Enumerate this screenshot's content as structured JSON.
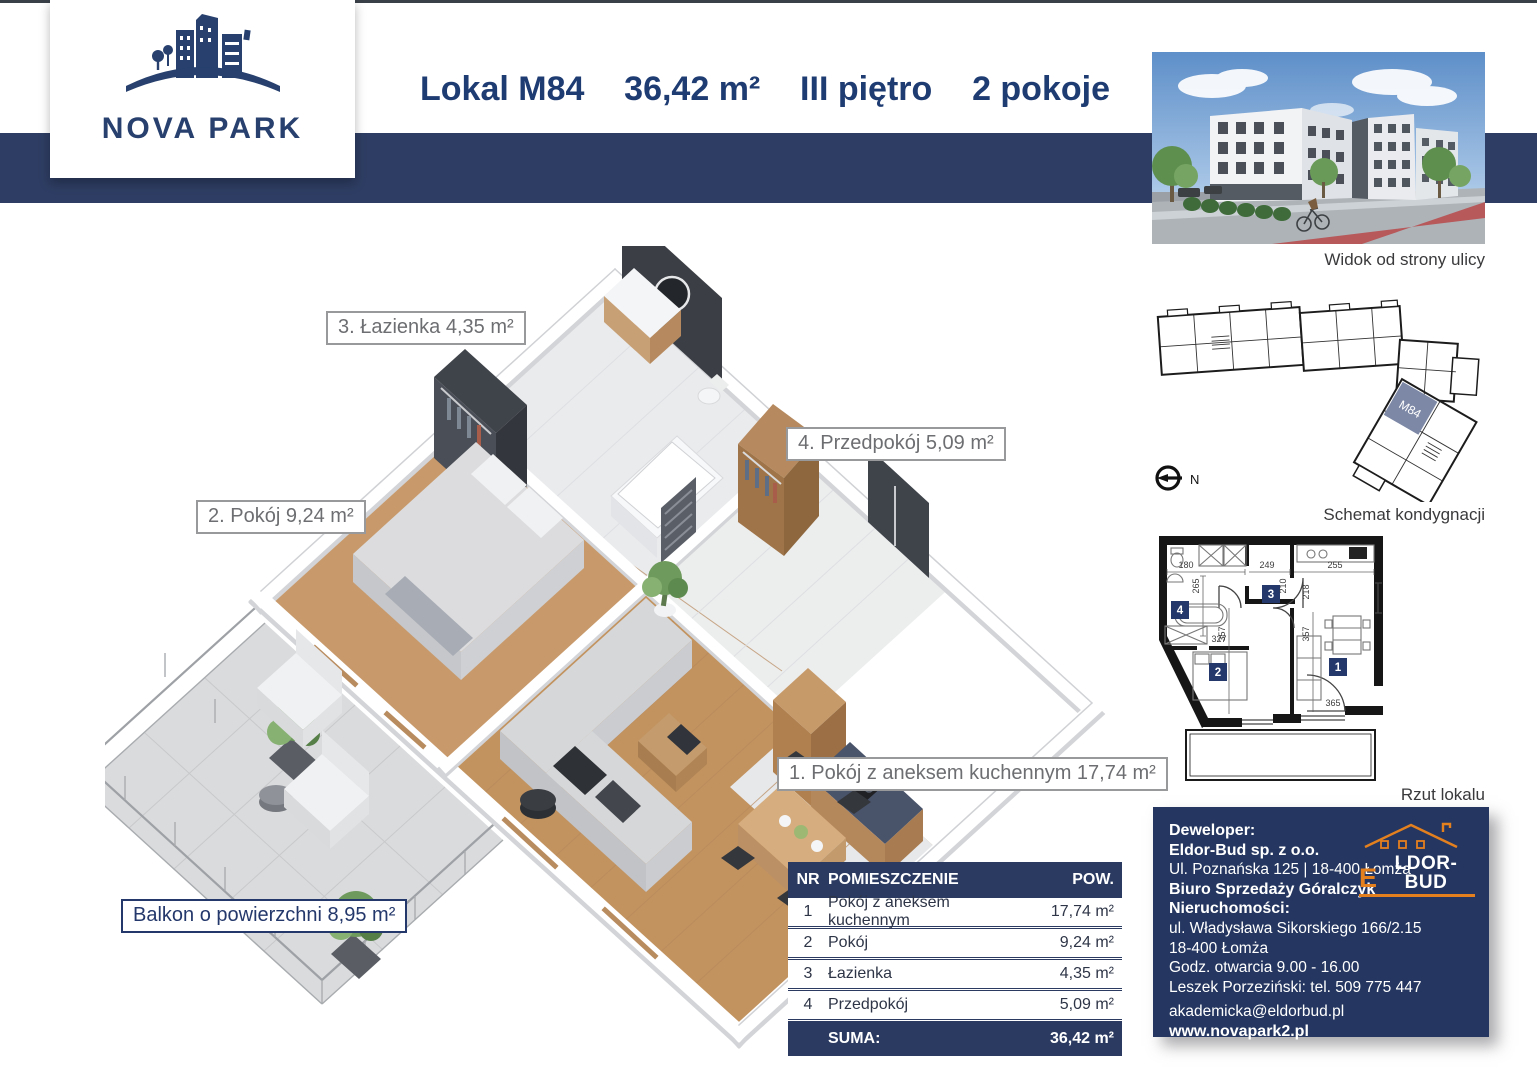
{
  "colors": {
    "navy": "#2a3a61",
    "band": "#2e3d63",
    "title": "#1e3b72",
    "orange": "#e5801f",
    "label_gray": "#6d6e71",
    "unit_highlight": "#7c88a6"
  },
  "brand": {
    "name": "NOVA PARK"
  },
  "header": {
    "unit": "Lokal M84",
    "area": "36,42 m²",
    "floor": "III piętro",
    "rooms": "2 pokoje",
    "features": [
      {
        "icon": "map-pin-icon",
        "lines": [
          "Bliskość Parku",
          "handlowego i centrum",
          "medycznego"
        ]
      },
      {
        "icon": "car-icon",
        "lines": [
          "Dobra komunikacja",
          "z centrum miasta"
        ]
      },
      {
        "icon": "plant-icon",
        "lines": [
          "Otwarte, zielone",
          "przestrzenie"
        ]
      }
    ]
  },
  "photo": {
    "caption": "Widok od strony ulicy"
  },
  "schematic": {
    "caption": "Schemat kondygnacji",
    "unit_badge": "M84",
    "compass": "N"
  },
  "rzut": {
    "caption": "Rzut lokalu",
    "badges": [
      "1",
      "2",
      "3",
      "4"
    ],
    "dims": [
      "180",
      "249",
      "255",
      "265",
      "210",
      "218",
      "357",
      "357",
      "327",
      "365"
    ]
  },
  "plan3d_labels": {
    "bathroom": "3. Łazienka 4,35 m²",
    "room": "2. Pokój 9,24 m²",
    "hall": "4. Przedpokój 5,09 m²",
    "living": "1. Pokój z aneksem kuchennym 17,74 m²",
    "balcony": "Balkon o powierzchni 8,95 m²"
  },
  "table": {
    "header": {
      "nr": "NR",
      "room": "POMIESZCZENIE",
      "area": "POW."
    },
    "rows": [
      {
        "nr": "1",
        "room": "Pokój z aneksem kuchennym",
        "area": "17,74 m²"
      },
      {
        "nr": "2",
        "room": "Pokój",
        "area": "9,24 m²"
      },
      {
        "nr": "3",
        "room": "Łazienka",
        "area": "4,35 m²"
      },
      {
        "nr": "4",
        "room": "Przedpokój",
        "area": "5,09 m²"
      }
    ],
    "footer": {
      "label": "SUMA:",
      "value": "36,42 m²"
    }
  },
  "developer": {
    "logo_text": {
      "first_letter": "E",
      "rest": "LDOR-BUD"
    },
    "lines": [
      "Deweloper:",
      "Eldor-Bud sp. z o.o.",
      "Ul. Poznańska 125 | 18-400 Łomża",
      "Biuro Sprzedaży Góralczyk Nieruchomości:",
      "ul. Władysława Sikorskiego 166/2.15",
      "18-400 Łomża",
      "Godz. otwarcia 9.00 - 16.00",
      "Leszek Porzeziński: tel. 509 775 447",
      "akademicka@eldorbud.pl",
      "www.novapark2.pl"
    ]
  }
}
